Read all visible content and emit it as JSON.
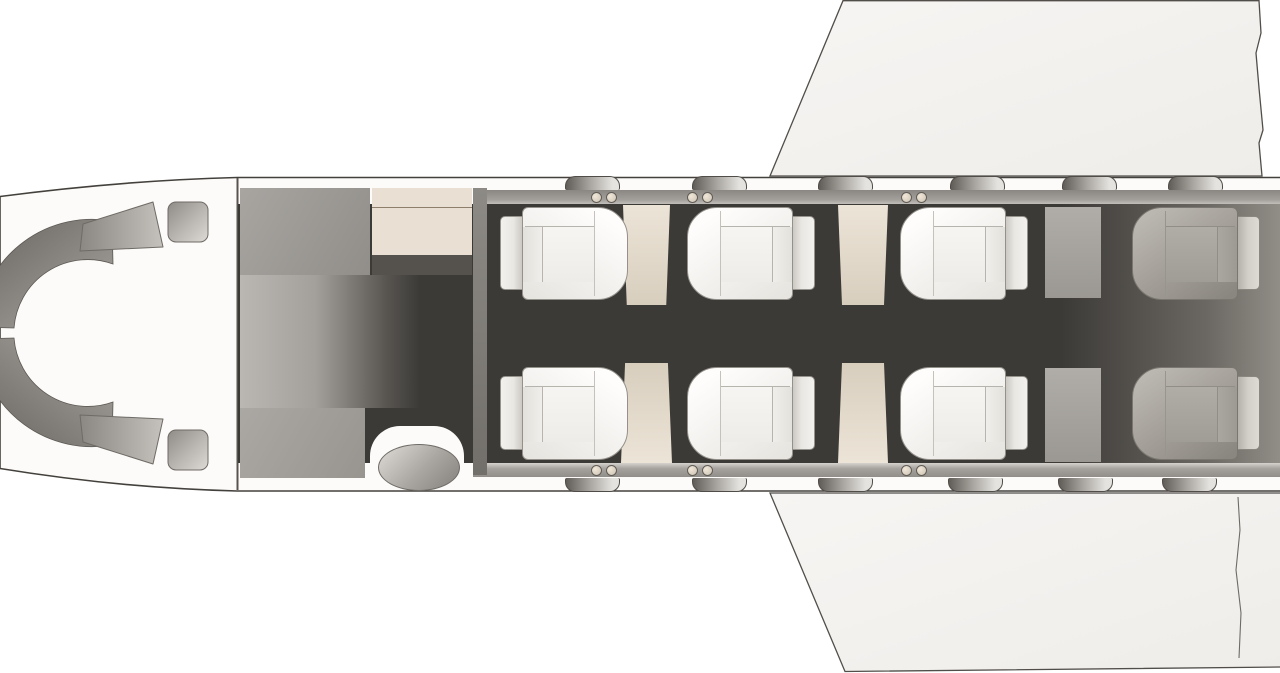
{
  "diagram": {
    "type": "aircraft-cabin-floor-plan",
    "view": "top-down",
    "subject": "business jet interior seat map",
    "crew_seat_count": 2,
    "passenger_seat_count": 8,
    "side_table_count": 4,
    "window_count_per_side": 6
  },
  "colors": {
    "background": "#ffffff",
    "fuselage_skin": "#fcfbf9",
    "outline": "#44413d",
    "wing": "#f5f3f0",
    "cabin_wall_rail": "#a3a09c",
    "floor": "#3c3a37",
    "aft_shadow": "#918d87",
    "seat_shell": "#f3f1ee",
    "rear_seat_shell": "#a29d97",
    "side_table": "#e4dbcb",
    "galley": "#e9e0d3",
    "cabinet_gray": "#9b9793",
    "hinge_dot": "#ddd3c2"
  },
  "cockpit": {
    "instrument_panel": "horseshoe-panel",
    "crew_seats": [
      "pilot-seat-left",
      "pilot-seat-right"
    ]
  },
  "cabin": {
    "rows": {
      "top_y": 207,
      "bottom_y": 367,
      "seat_h": 93
    },
    "seats": [
      {
        "id": "seat-1-left",
        "row": "top",
        "x": 500,
        "facing": "aft",
        "shade": "light"
      },
      {
        "id": "seat-1-right",
        "row": "bottom",
        "x": 500,
        "facing": "aft",
        "shade": "light"
      },
      {
        "id": "seat-2-left",
        "row": "top",
        "x": 687,
        "facing": "forward",
        "shade": "light"
      },
      {
        "id": "seat-2-right",
        "row": "bottom",
        "x": 687,
        "facing": "forward",
        "shade": "light"
      },
      {
        "id": "seat-3-left",
        "row": "top",
        "x": 900,
        "facing": "forward",
        "shade": "light"
      },
      {
        "id": "seat-3-right",
        "row": "bottom",
        "x": 900,
        "facing": "forward",
        "shade": "light"
      },
      {
        "id": "seat-4-left",
        "row": "top",
        "x": 1132,
        "facing": "forward",
        "shade": "dark"
      },
      {
        "id": "seat-4-right",
        "row": "bottom",
        "x": 1132,
        "facing": "forward",
        "shade": "dark"
      }
    ],
    "tables": [
      {
        "id": "table-1-left",
        "x": 623,
        "y": 205,
        "w": 47,
        "h": 100,
        "taper": "aisle-bottom"
      },
      {
        "id": "table-2-left",
        "x": 838,
        "y": 205,
        "w": 50,
        "h": 100,
        "taper": "aisle-bottom"
      },
      {
        "id": "table-1-right",
        "x": 621,
        "y": 363,
        "w": 51,
        "h": 100,
        "taper": "aisle-top"
      },
      {
        "id": "table-2-right",
        "x": 838,
        "y": 363,
        "w": 50,
        "h": 100,
        "taper": "aisle-top"
      }
    ],
    "dividers": [
      {
        "id": "aft-divider-left",
        "x": 1045,
        "y": 207,
        "w": 56,
        "h": 91
      },
      {
        "id": "aft-divider-right",
        "x": 1045,
        "y": 368,
        "w": 56,
        "h": 94
      }
    ],
    "fixtures": [
      {
        "id": "forward-wardrobe",
        "x": 240,
        "y": 188,
        "w": 130,
        "h": 87,
        "style": "wardrobe"
      },
      {
        "id": "galley-unit",
        "x": 372,
        "y": 188,
        "w": 100,
        "h": 67,
        "style": "galley"
      },
      {
        "id": "galley-shelf",
        "x": 372,
        "y": 255,
        "w": 100,
        "h": 20,
        "style": "shelf"
      },
      {
        "id": "entry-vestibule",
        "x": 240,
        "y": 275,
        "w": 180,
        "h": 133,
        "style": "vestibule"
      },
      {
        "id": "forward-cabinet",
        "x": 240,
        "y": 408,
        "w": 125,
        "h": 70,
        "style": "cabinet"
      },
      {
        "id": "cabin-partition",
        "x": 473,
        "y": 188,
        "w": 14,
        "h": 287,
        "style": "partition"
      }
    ],
    "entry": {
      "notch": {
        "x": 370,
        "y": 426,
        "w": 94,
        "h": 64
      },
      "step": {
        "x": 378,
        "y": 444,
        "w": 82,
        "h": 47
      }
    },
    "windows": {
      "top_x": [
        565,
        692,
        818,
        950,
        1062,
        1168
      ],
      "bottom_x": [
        565,
        692,
        818,
        948,
        1058,
        1162
      ],
      "top_y": 176,
      "bottom_y": 478
    },
    "door_dots": {
      "x_pairs": [
        591,
        687,
        901
      ],
      "top_y": 192,
      "bottom_y": 465
    }
  }
}
